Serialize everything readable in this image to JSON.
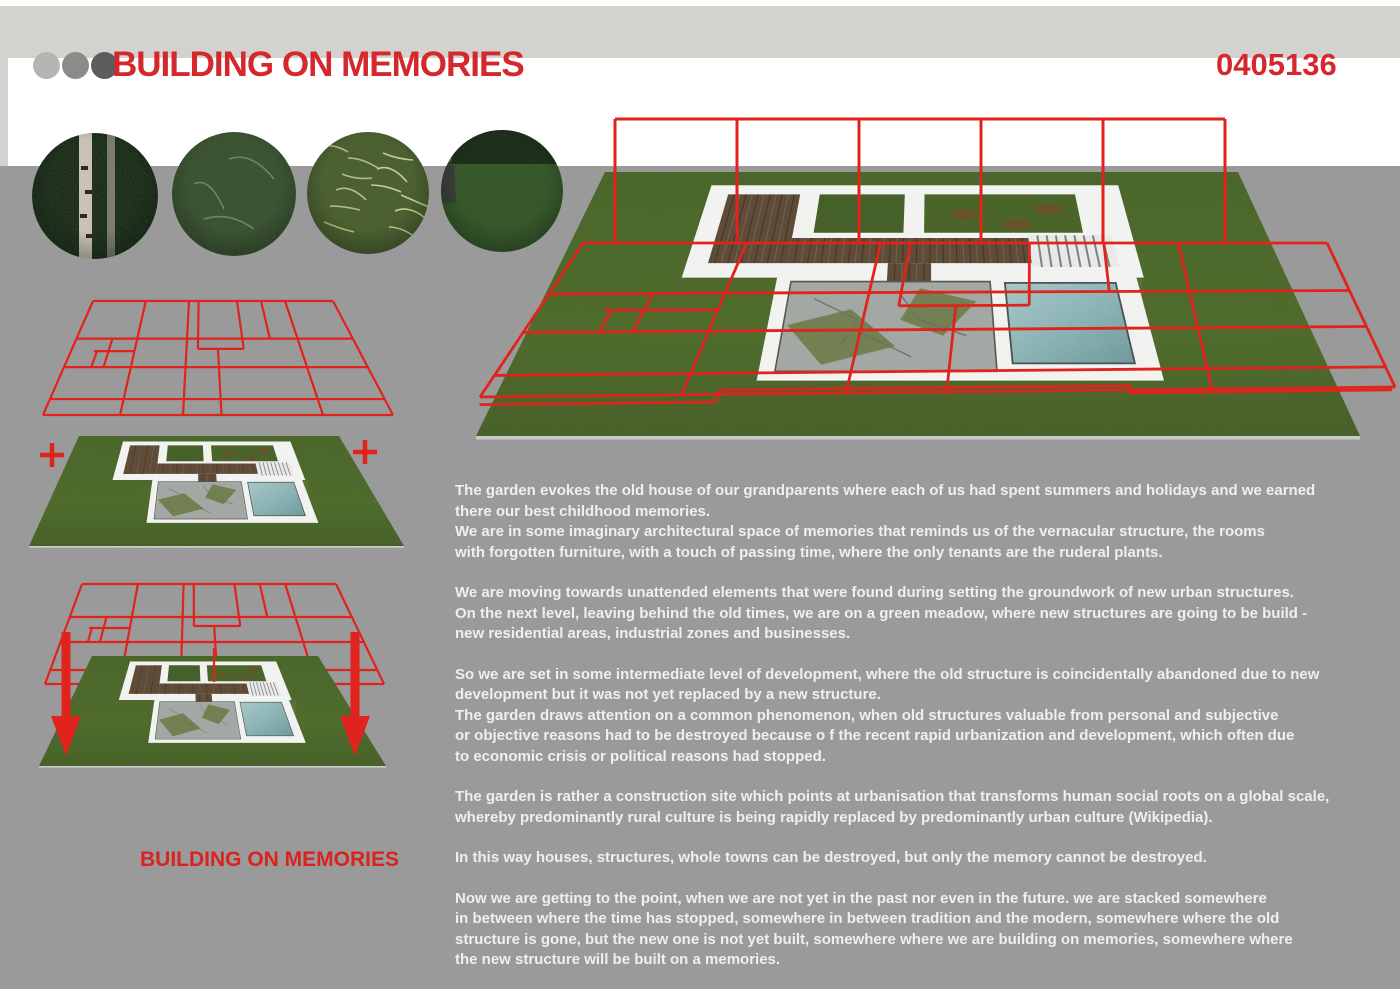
{
  "header": {
    "title": "BUILDING ON MEMORIES",
    "project_number": "0405136",
    "dots": [
      "light-gray",
      "medium-gray",
      "dark-gray"
    ]
  },
  "photos": [
    "forest-trunks",
    "fern-thicket",
    "dry-grass-tangle",
    "ruderal-plants-with-man"
  ],
  "caption": {
    "label": "BUILDING ON MEMORIES"
  },
  "article": {
    "paragraphs": [
      "The garden evokes the old house of our grandparents where each of us had spent summers and holidays and we earned\nthere our best childhood memories.\nWe are in some imaginary architectural space of memories that reminds us of the vernacular structure, the rooms\nwith forgotten furniture, with a touch of passing time, where the only tenants are the ruderal plants.",
      "We are moving towards unattended elements that were found during setting the groundwork of new urban structures.\nOn the next level, leaving behind the old times, we are on a green meadow, where new structures are going to be build -\nnew residential areas, industrial zones and businesses.",
      "So we are set in some intermediate level of development, where the old structure is coincidentally abandoned due to new\ndevelopment but it was not yet replaced by a new structure.\nThe garden draws attention on a common phenomenon, when old structures valuable from personal and subjective\nor objective reasons had to be destroyed because o  f the recent rapid urbanization and development, which often due\nto economic crisis or political reasons had stopped.",
      "The garden is rather a construction site which points at urbanisation that transforms human social roots on a global scale,\nwhereby predominantly rural culture is being rapidly replaced by predominantly urban culture (Wikipedia).",
      "In this way houses, structures, whole towns can be destroyed, but only the memory cannot be destroyed.",
      "Now we are getting to the point, when we are not yet in the past nor even in the future. we are stacked somewhere\nin between where the time has stopped, somewhere in between tradition and the modern, somewhere where the old\nstructure is gone, but the new one is not yet built, somewhere where we are building on memories, somewhere where\nthe new structure will be built on a memories."
    ]
  },
  "colors": {
    "accent_red": "#e0231c",
    "title_red": "#d5282c",
    "background_gray": "#9b9a9a",
    "band_light_gray": "#d4d2cf",
    "band_white": "#ffffff",
    "text_white": "#f1efec",
    "grass_green": "#4f6b2b",
    "pool_teal": "#8fb5b7",
    "wood_brown": "#64523c",
    "stone_gray": "#a3a8a4"
  }
}
